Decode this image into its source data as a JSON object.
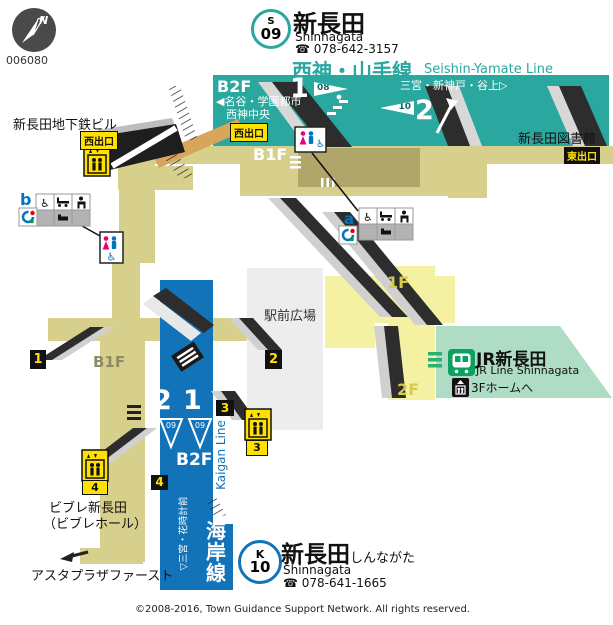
{
  "map_id": "006080",
  "compass": {
    "north_letter": "N"
  },
  "header": {
    "line_badge": {
      "letter": "S",
      "number": "09"
    },
    "station_name": "新長田",
    "station_romaji": "Shinnagata",
    "phone": "☎ 078-642-3157",
    "line_name_jp": "西神・山手線",
    "line_name_en": "Seishin-Yamate Line"
  },
  "seishin_area": {
    "floor": "B2F",
    "direction_left_line1": "◀名谷・学園都市",
    "direction_left_line2": "西神中央",
    "direction_right": "三宮・新神戸・谷上▷",
    "platform_left_number": "1",
    "platform_left_wedge": "08",
    "platform_right_number": "2",
    "platform_right_wedge": "10"
  },
  "concourse": {
    "west_exit_label_building": "西出口",
    "west_exit_label_platform": "西出口",
    "east_exit_label": "東出口",
    "b1f_label_right": "B1F",
    "b1f_label_left": "B1F",
    "floor_1f_label": "1F",
    "floor_2f_label": "2F",
    "plaza_label": "駅前広場",
    "subway_building_label": "新長田地下鉄ビル",
    "library_label": "新長田図書館"
  },
  "jr_area": {
    "station_label": "JR新長田",
    "station_label_en": "JR Line Shinnagata",
    "to_platform_label": "3Fホームへ"
  },
  "kaigan_area": {
    "floor": "B2F",
    "platform_left_number": "2",
    "platform_right_number": "1",
    "platform_wedge_left": "09",
    "platform_wedge_right": "09",
    "line_name_jp": "海岸線",
    "line_name_en": "Kaigan Line",
    "direction_label": "▽三宮・花時計前"
  },
  "kaigan_header": {
    "line_badge": {
      "letter": "K",
      "number": "10"
    },
    "station_name": "新長田",
    "station_hiragana": "しんながた",
    "station_romaji": "Shinnagata",
    "phone": "☎ 078-641-1665"
  },
  "exits": {
    "exit1": "1",
    "exit2": "2",
    "exit3": "3",
    "exit4": "4",
    "elevator3_tag": "3",
    "elevator4_tag": "4"
  },
  "legend": {
    "marker_a": "a",
    "marker_b": "b"
  },
  "buildings": {
    "vivre_line1": "ビブレ新長田",
    "vivre_line2": "（ビブレホール）",
    "asta_label": "アスタプラザファースト"
  },
  "footer": {
    "copyright": "©2008-2016, Town Guidance Support Network. All rights reserved."
  },
  "icons": {
    "wheelchair": "♿"
  },
  "colors": {
    "seishin_teal": "#2AA79F",
    "kaigan_blue": "#1273B9",
    "concourse_khaki": "#D7D08C",
    "paid_area_olive": "#B0A669",
    "ground_1f_yellow": "#F4F2A2",
    "jr_mint": "#AEDCC4",
    "jr_green": "#0BA160",
    "ramp_tan": "#D8A55C",
    "badge_yellow": "#FFE100",
    "plaza_gray": "#EDEDED",
    "female_pink": "#E4007F",
    "male_blue": "#0075C2"
  }
}
